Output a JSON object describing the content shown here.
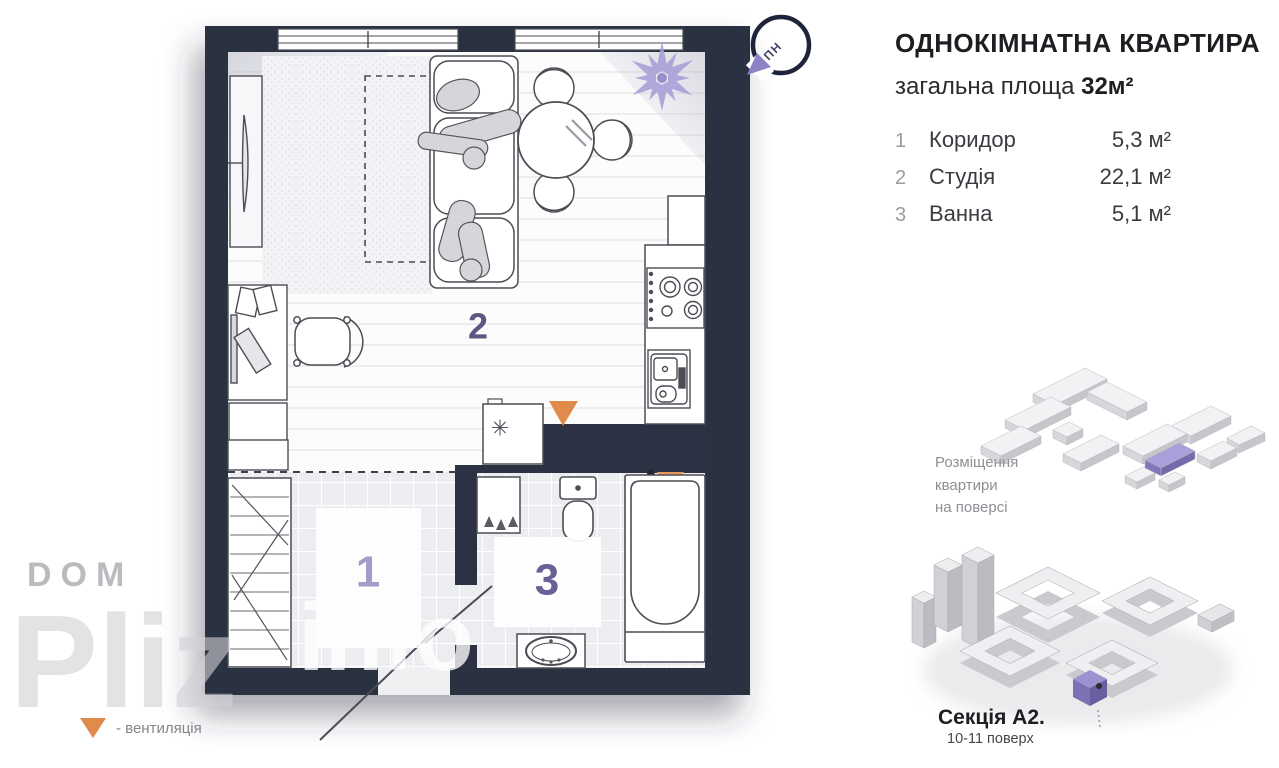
{
  "header": {
    "title": "ОДНОКІМНАТНА КВАРТИРА",
    "subtitle_prefix": "загальна площа",
    "total_area": "32м²"
  },
  "rooms": [
    {
      "num": "1",
      "name": "Коридор",
      "area": "5,3 м²"
    },
    {
      "num": "2",
      "name": "Студія",
      "area": "22,1 м²"
    },
    {
      "num": "3",
      "name": "Ванна",
      "area": "5,1 м²"
    }
  ],
  "plan": {
    "north_label": "ПН",
    "room_numbers": {
      "corridor": "1",
      "studio": "2",
      "bathroom": "3"
    },
    "freezer_symbol": "✳"
  },
  "placement": {
    "label": "Розміщення\nквартири\nна поверсі"
  },
  "building": {
    "section": "Секція А2.",
    "floors": "10-11 поверх"
  },
  "watermark": {
    "line1": "DOM",
    "line2": "Pliz",
    "line3": "info"
  },
  "legend": {
    "vent_label": "- вентиляція"
  },
  "colors": {
    "wall": "#2c3143",
    "accent_purple": "#8c82c6",
    "number_purple": "#6b6095",
    "vent_orange": "#e08a4c"
  }
}
